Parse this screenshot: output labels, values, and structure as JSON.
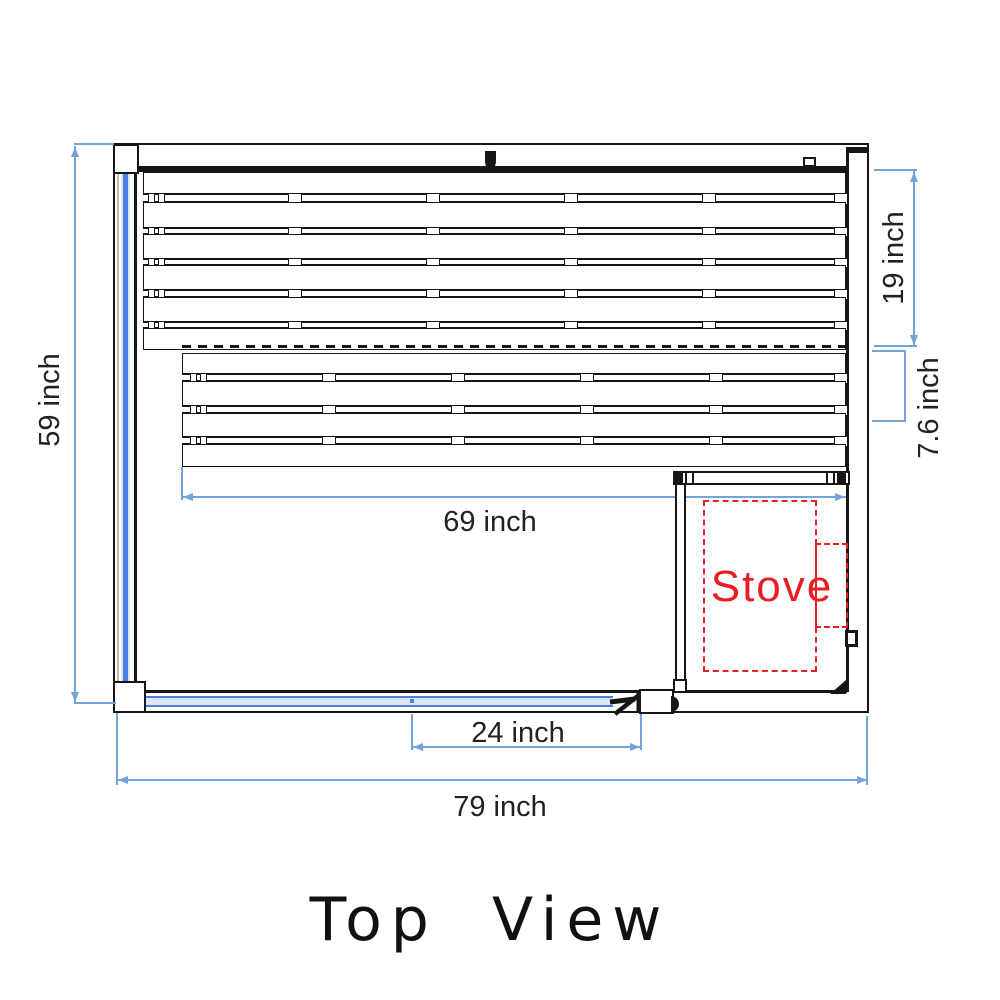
{
  "title": "Top View",
  "stove": {
    "label": "Stove"
  },
  "dimensions": {
    "left_height": "59 inch",
    "upper_bench_depth": "19 inch",
    "bench_step_gap": "7.6 inch",
    "lower_bench_length": "69 inch",
    "door_width": "24 inch",
    "total_width": "79 inch"
  },
  "colors": {
    "dim": "#73a3d9",
    "wall": "#161616",
    "glass_strong": "#4a80dc",
    "glass_light": "#dbe7f8",
    "red": "#ea1d23",
    "ink": "#1c1c1c"
  },
  "figure": {
    "benches": [
      {
        "name": "upper-bench",
        "x": 143,
        "y": 172,
        "w": 703,
        "rows": [
          [
            "p",
            22
          ],
          [
            "c",
            8
          ],
          [
            "p",
            26
          ],
          [
            "c",
            6
          ],
          [
            "p",
            25
          ],
          [
            "c",
            6
          ],
          [
            "p",
            25
          ],
          [
            "c",
            7
          ],
          [
            "p",
            25
          ],
          [
            "c",
            6
          ],
          [
            "p",
            22
          ]
        ],
        "clips": [
          5,
          15,
          145,
          283,
          421,
          559,
          691
        ]
      },
      {
        "name": "lower-bench",
        "x": 182,
        "y": 353,
        "w": 664,
        "rows": [
          [
            "p",
            21
          ],
          [
            "c",
            7
          ],
          [
            "p",
            25
          ],
          [
            "c",
            7
          ],
          [
            "p",
            24
          ],
          [
            "c",
            7
          ],
          [
            "p",
            23
          ]
        ],
        "clips": [
          8,
          18,
          140,
          269,
          398,
          527,
          652
        ]
      }
    ]
  }
}
